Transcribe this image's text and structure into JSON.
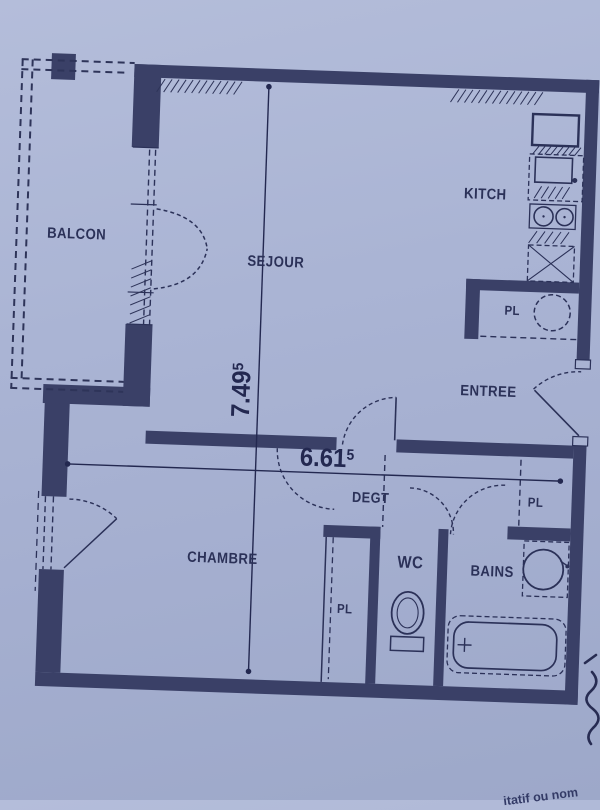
{
  "palette": {
    "paper_light": "#b4bdda",
    "paper": "#a9b3d3",
    "paper_dark": "#9da8c9",
    "ink": "#2b3158",
    "wall_fill": "#3a4067",
    "dim_ink": "#232850"
  },
  "labels": {
    "balcon": "BALCON",
    "sejour": "SEJOUR",
    "kitchen": "KITCH",
    "entree": "ENTREE",
    "hallway": "DEGT",
    "bedroom": "CHAMBRE",
    "wc": "WC",
    "bathroom": "BAINS",
    "closet_kitchen": "PL",
    "closet_entree": "PL",
    "closet_bedroom": "PL"
  },
  "dimensions": {
    "vertical": {
      "value": "7.49",
      "superscript": "5"
    },
    "horizontal": {
      "value": "6.61",
      "superscript": "5"
    }
  },
  "annotations": {
    "bottom_partial_text": "itatif ou nom"
  }
}
